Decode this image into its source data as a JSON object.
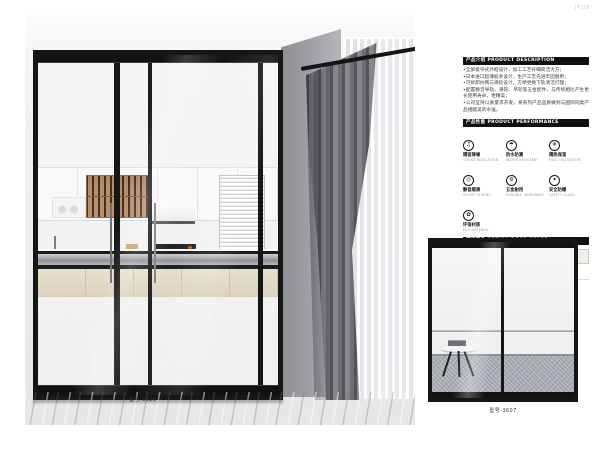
{
  "page": {
    "number": "JT/28"
  },
  "main_photo": {
    "caption": "型号-3620"
  },
  "small_photo": {
    "caption": "型号-3607"
  },
  "sections": {
    "description": {
      "title": "产品介绍 PRODUCT DESCRIPTION",
      "bullets": [
        "•全屏极窄式外框设计，加工工艺纤细简洁大方；",
        "•日本进口超薄胶条设计，生产工艺先进牢固耐用；",
        "•可拆卸纱网与滑轮设计，方便更换下轨清洁打理；",
        "•配置静音导轨、滑轮、吊轮等五金配件，与传统相比产生更长使用寿命，更精美；",
        "•公司坚持以质量求开发，将系列产品品质做到与国际同类产品相媲美的水准。"
      ]
    },
    "performance": {
      "title": "产品性能 PRODUCT PERFORMANCE",
      "items": [
        {
          "glyph": "♫",
          "label": "隔音降噪",
          "sub": "SOUND INSULATION"
        },
        {
          "glyph": "☂",
          "label": "防水防潮",
          "sub": "WATER RESISTANT"
        },
        {
          "glyph": "❄",
          "label": "隔热保温",
          "sub": "HEAT INSULATION"
        },
        {
          "glyph": "◎",
          "label": "静音顺滑",
          "sub": "SILENT SLIDING"
        },
        {
          "glyph": "⚙",
          "label": "五金耐用",
          "sub": "DURABLE HARDWARE"
        },
        {
          "glyph": "✦",
          "label": "安全防爆",
          "sub": "SAFETY GLASS"
        },
        {
          "glyph": "✿",
          "label": "环保材质",
          "sub": "ECO MATERIAL"
        }
      ]
    },
    "colors": {
      "title": "可选颜色 OPTION DOOR COLOR",
      "swatches": [
        {
          "label": "色卡-001",
          "hex": "#1b1b1b"
        },
        {
          "label": "色卡-002",
          "hex": "#f1eee7"
        }
      ]
    }
  }
}
